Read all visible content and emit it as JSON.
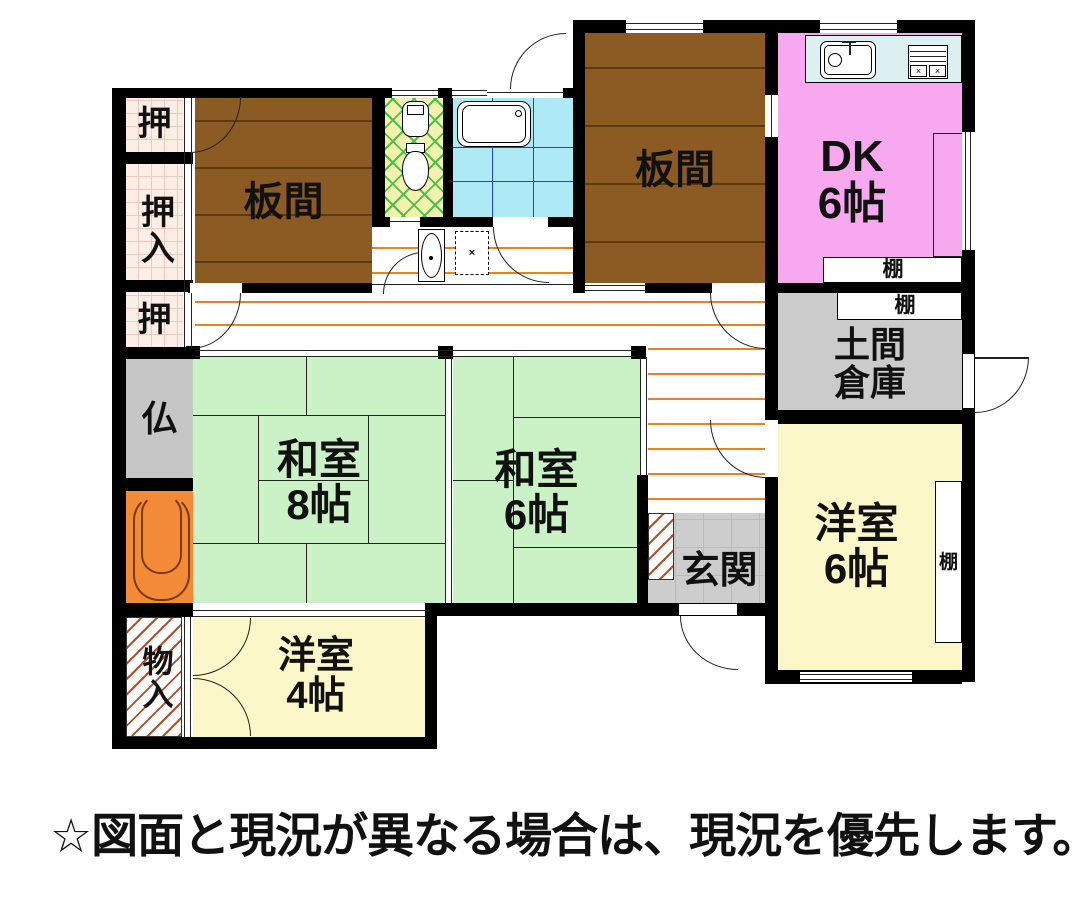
{
  "note": "☆図面と現況が異なる場合は、現況を優先します。",
  "rooms": {
    "itanoma1": {
      "label": "板間"
    },
    "itanoma2": {
      "label": "板間"
    },
    "dk": {
      "label": "DK",
      "size": "6帖"
    },
    "washitsu8": {
      "label": "和室",
      "size": "8帖"
    },
    "washitsu6": {
      "label": "和室",
      "size": "6帖"
    },
    "yoshitsu6": {
      "label": "洋室",
      "size": "6帖"
    },
    "yoshitsu4": {
      "label": "洋室",
      "size": "4帖"
    },
    "genkan": {
      "label": "玄関"
    },
    "doma": {
      "label": "土間",
      "label2": "倉庫"
    },
    "oshi_top": {
      "label": "押"
    },
    "oshiire": {
      "label": "押入"
    },
    "oshi_mid": {
      "label": "押"
    },
    "butsudan": {
      "label": "仏"
    },
    "monoire": {
      "label": "物入"
    },
    "shelf_dk": {
      "label": "棚"
    },
    "shelf_doma": {
      "label": "棚"
    },
    "shelf_yoshitsu6": {
      "label": "棚"
    }
  },
  "colors": {
    "wood_floor": "#8C5A23",
    "dk_pink": "#F7A8EE",
    "tatami_green": "#CBF1C6",
    "western_yellow": "#FBF7C9",
    "storage_gray": "#CBCBCB",
    "tokonoma_orange": "#F28A38",
    "bath_cyan": "#AEE9F6",
    "toilet_yellow": "#F4F1AE",
    "closet_pink": "#FBEEE6",
    "corridor_line_orange": "#E8831F",
    "wall_black": "#000000"
  }
}
